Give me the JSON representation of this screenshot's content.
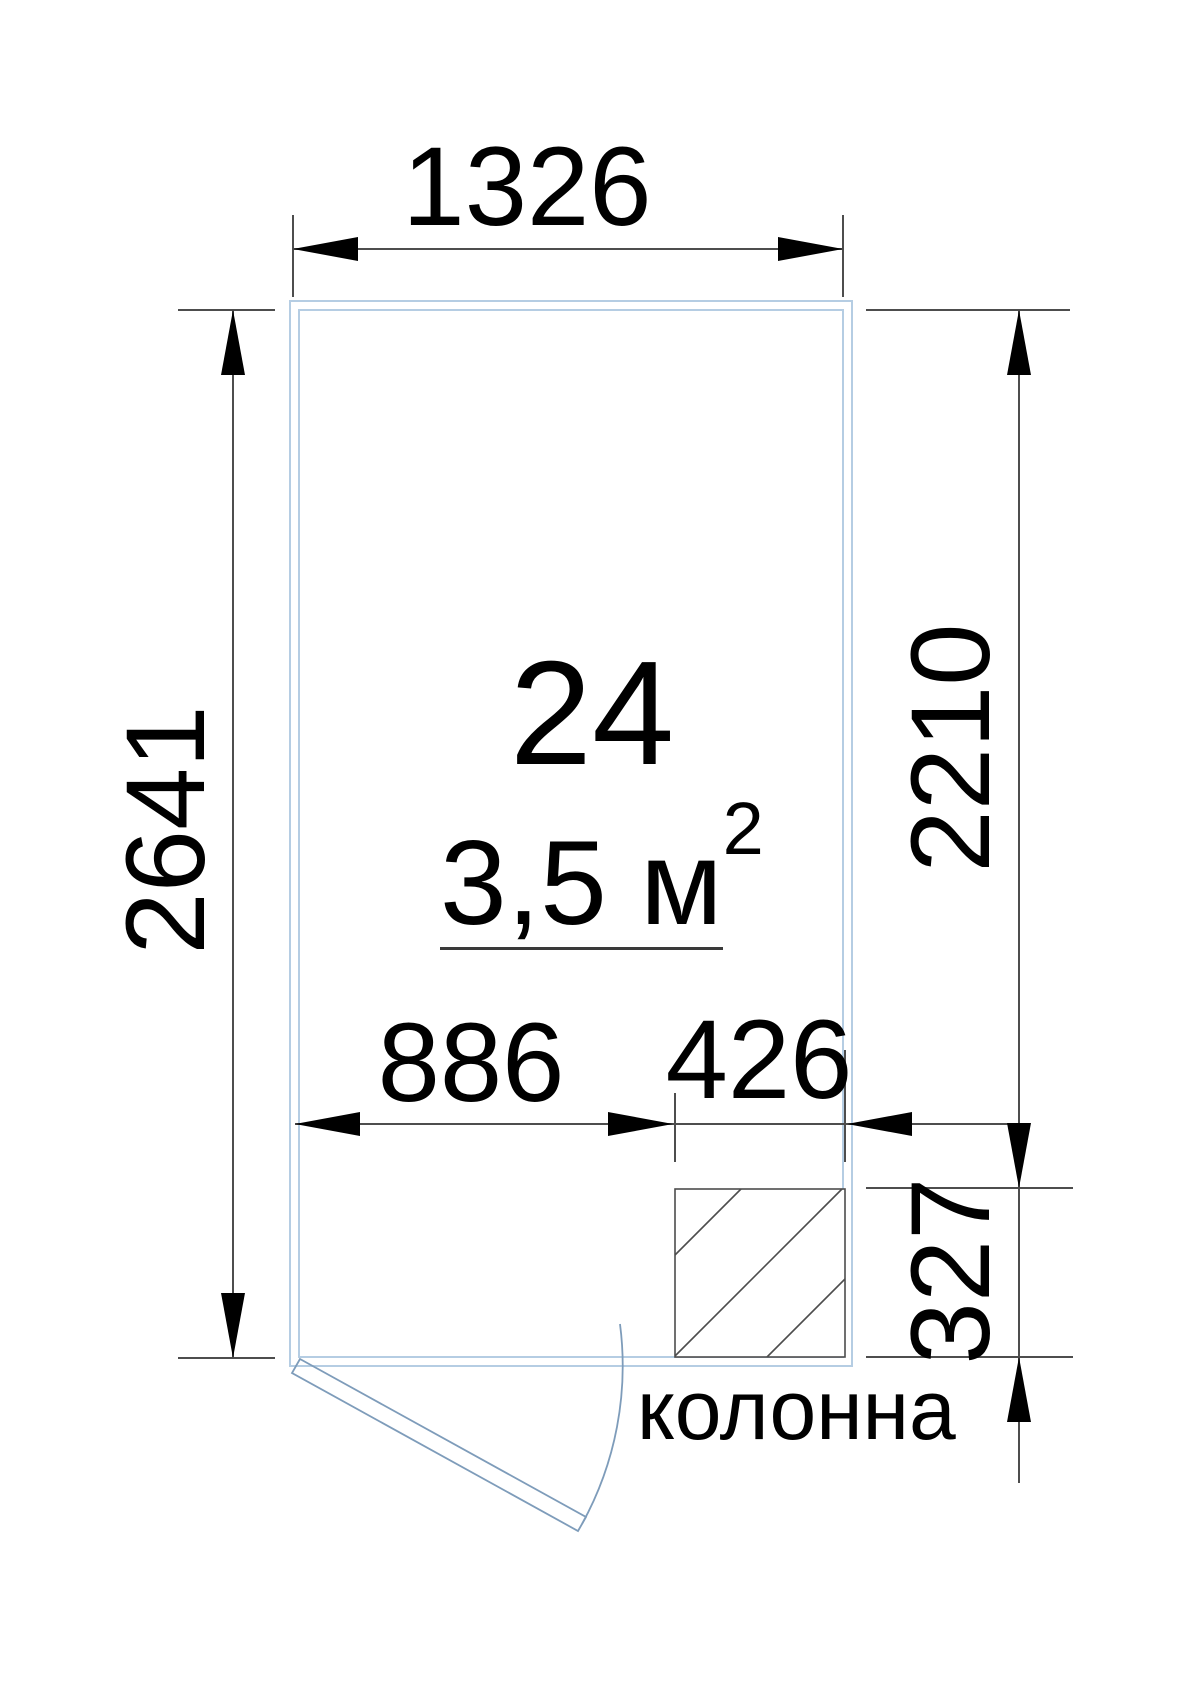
{
  "drawing": {
    "room_number": "24",
    "area_value": "3,5 м",
    "area_sup": "2",
    "column_label": "колонна",
    "dimensions": {
      "top_width": "1326",
      "left_height": "2641",
      "right_height_upper": "2210",
      "right_height_lower": "327",
      "bottom_left_width": "886",
      "bottom_right_width": "426"
    },
    "colors": {
      "wall": "#b5cde3",
      "door": "#7e9cba",
      "dimension_lines": "#4d4d4d",
      "text": "#000000"
    }
  }
}
